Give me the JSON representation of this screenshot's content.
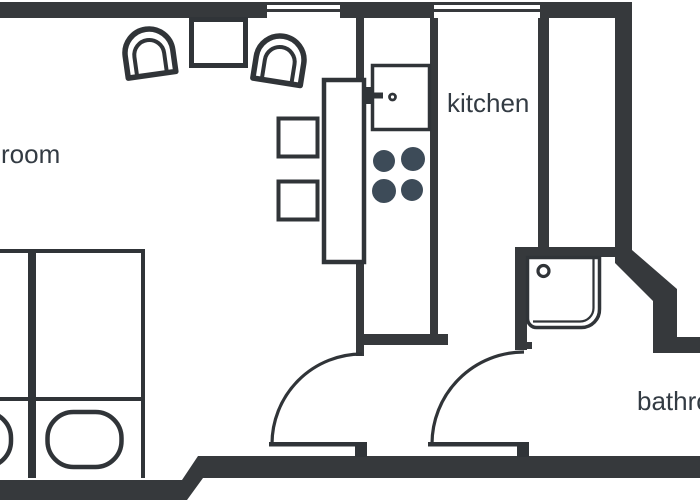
{
  "floor_plan": {
    "title": "apartment floor plan",
    "labels": {
      "room": "room",
      "kitchen": "kitchen",
      "bathroom": "bathroom"
    },
    "fixtures": {
      "windows": 2,
      "doors": 2,
      "beds": 2,
      "pillows": 2,
      "dining_table": 1,
      "chairs": 2,
      "counter": 1,
      "stools": 2,
      "sink": 1,
      "stove_burners": 4,
      "shower": 1
    },
    "colors": {
      "wall": "#36393c",
      "line": "#303438",
      "burner": "#3d4b58",
      "text": "#333b43",
      "background": "#ffffff"
    }
  }
}
